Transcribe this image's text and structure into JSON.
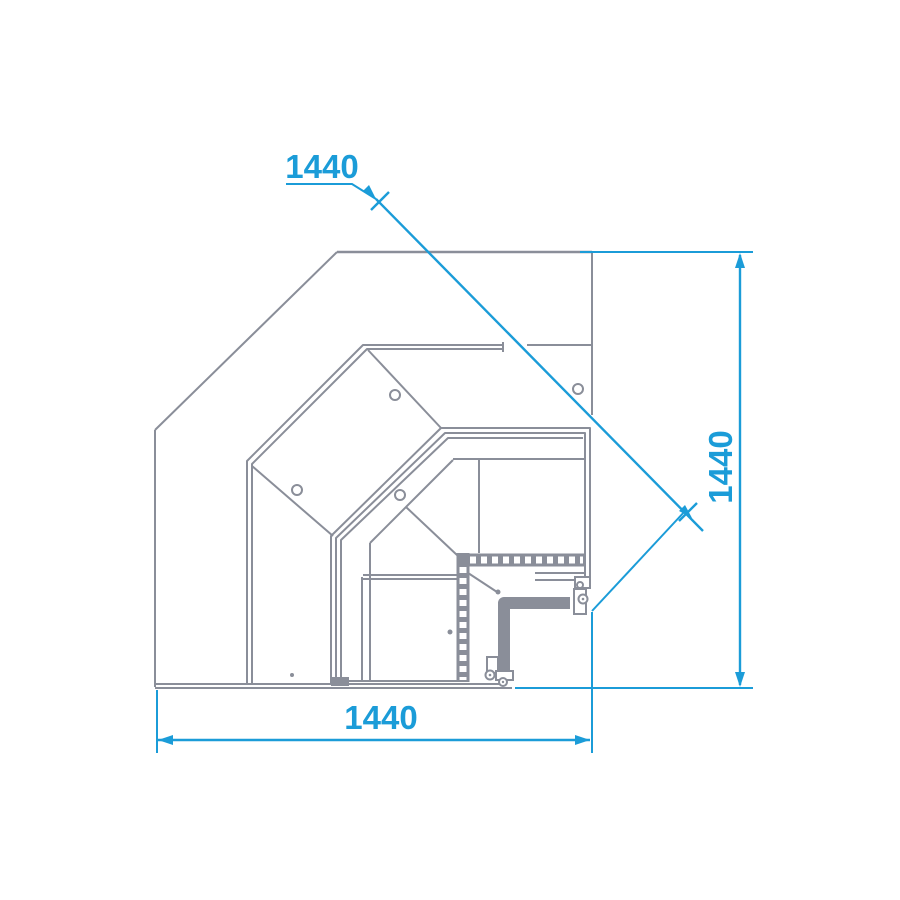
{
  "drawing": {
    "description": "plan view technical drawing of a 90-degree corner display counter",
    "colors": {
      "line_gray": "#8a8e99",
      "dimension_accent": "#1b9cd8",
      "background": "#ffffff"
    }
  },
  "dimensions": {
    "diagonal_label": "1440",
    "vertical_label": "1440",
    "horizontal_label": "1440"
  }
}
